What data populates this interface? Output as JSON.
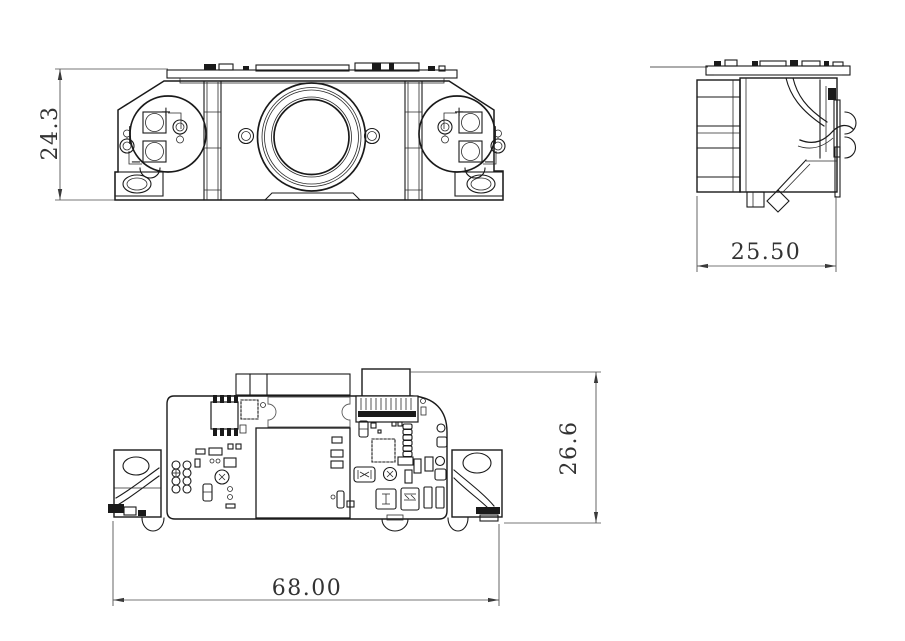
{
  "drawing": {
    "type": "mechanical-3-view-cad-drawing",
    "background": "#ffffff",
    "line_color": "#1a1a1a",
    "dimension_color": "#3a3a3a"
  },
  "dims": {
    "front_height": "24.3",
    "side_width": "25.50",
    "overall_width": "68.00",
    "bottom_height": "26.6"
  },
  "markers": {
    "plus": "+",
    "minus": "−"
  }
}
